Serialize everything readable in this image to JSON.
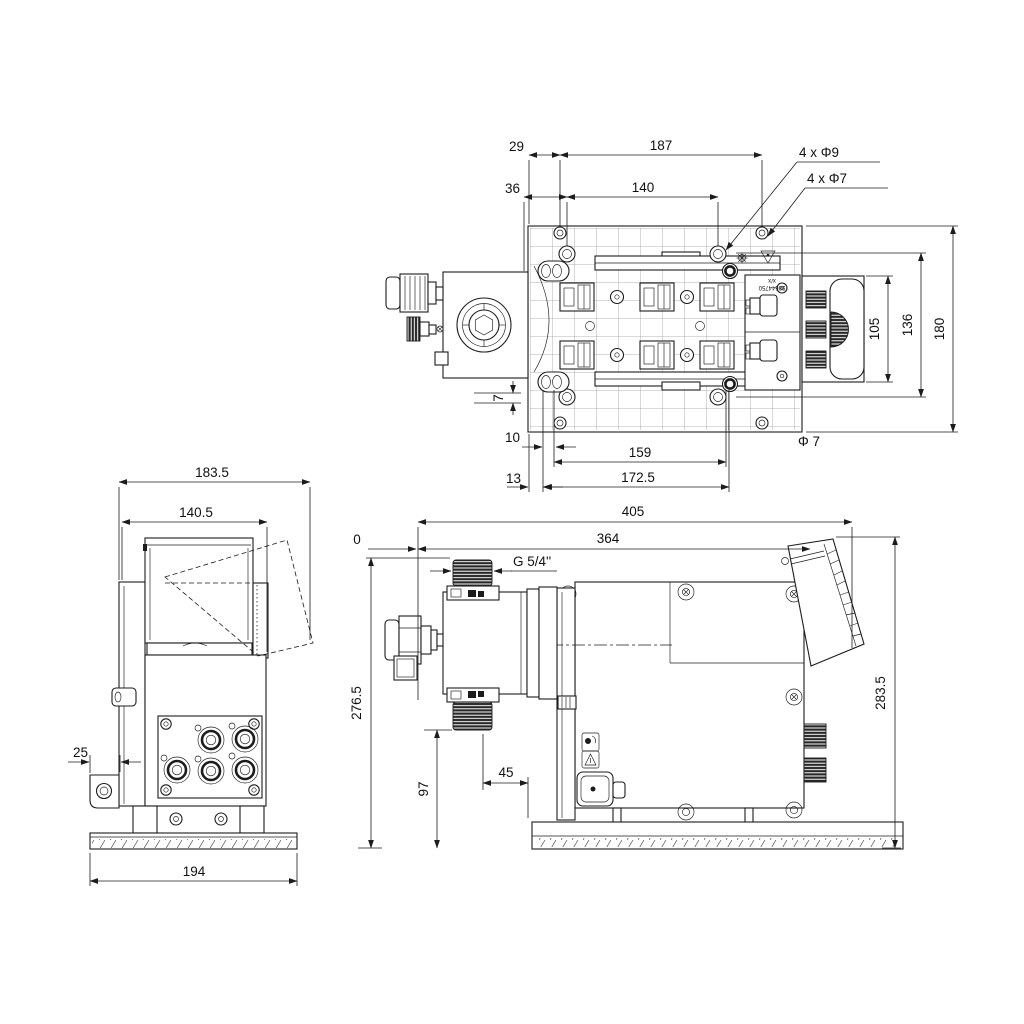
{
  "top": {
    "d29": "29",
    "d187": "187",
    "d36": "36",
    "d140": "140",
    "holes9": "4 x Φ9",
    "holes7": "4 x Φ7",
    "d105": "105",
    "d136": "136",
    "d180": "180",
    "d7": "7",
    "d10": "10",
    "d159": "159",
    "phi7": "Φ 7",
    "d13": "13",
    "d172": "172.5",
    "plate_line1": "x/x",
    "plate_line2": "98644750"
  },
  "side": {
    "d183": "183.5",
    "d140": "140.5",
    "d25": "25",
    "d194": "194"
  },
  "front": {
    "d405": "405",
    "d364": "364",
    "d0": "0",
    "thread": "G 5/4''",
    "d276": "276.5",
    "d97": "97",
    "d45": "45",
    "d283": "283.5"
  }
}
